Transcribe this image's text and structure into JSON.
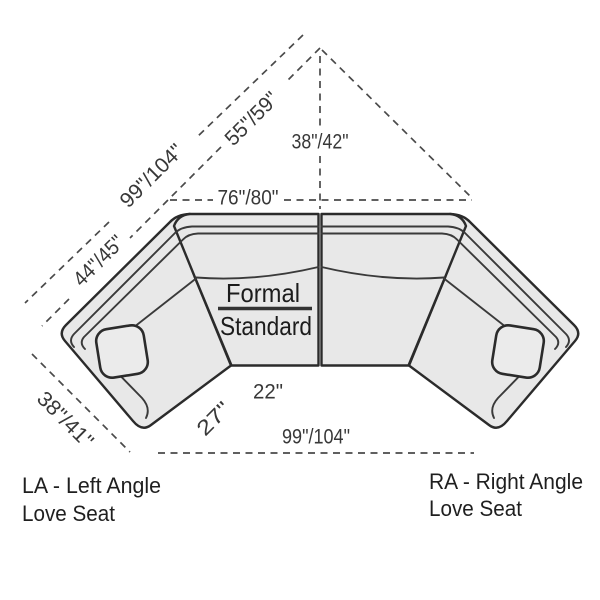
{
  "diagram": {
    "kind": "sectional-sofa-dimension-diagram",
    "colors": {
      "background": "#ffffff",
      "sofa_fill": "#e8e8e8",
      "sofa_outline": "#2b2b2b",
      "dimension_line": "#4a4a4a",
      "dimension_text": "#383838",
      "label_text": "#1f1f1f"
    },
    "dimensions": {
      "left_outer_length": "99\"/104\"",
      "left_inner_length": "55\"/59\"",
      "left_back_width": "44\"/45\"",
      "center_depth": "38\"/42\"",
      "inner_back_width": "76\"/80\"",
      "left_wing_depth": "38\"/41\"",
      "seat_front_width": "22\"",
      "wing_front_width": "27\"",
      "overall_width": "99\"/104\""
    },
    "style_label": {
      "line1": "Formal",
      "line2": "Standard"
    },
    "left_piece_label": {
      "line1": "LA - Left Angle",
      "line2": "Love Seat"
    },
    "right_piece_label": {
      "line1": "RA - Right Angle",
      "line2": "Love Seat"
    }
  }
}
